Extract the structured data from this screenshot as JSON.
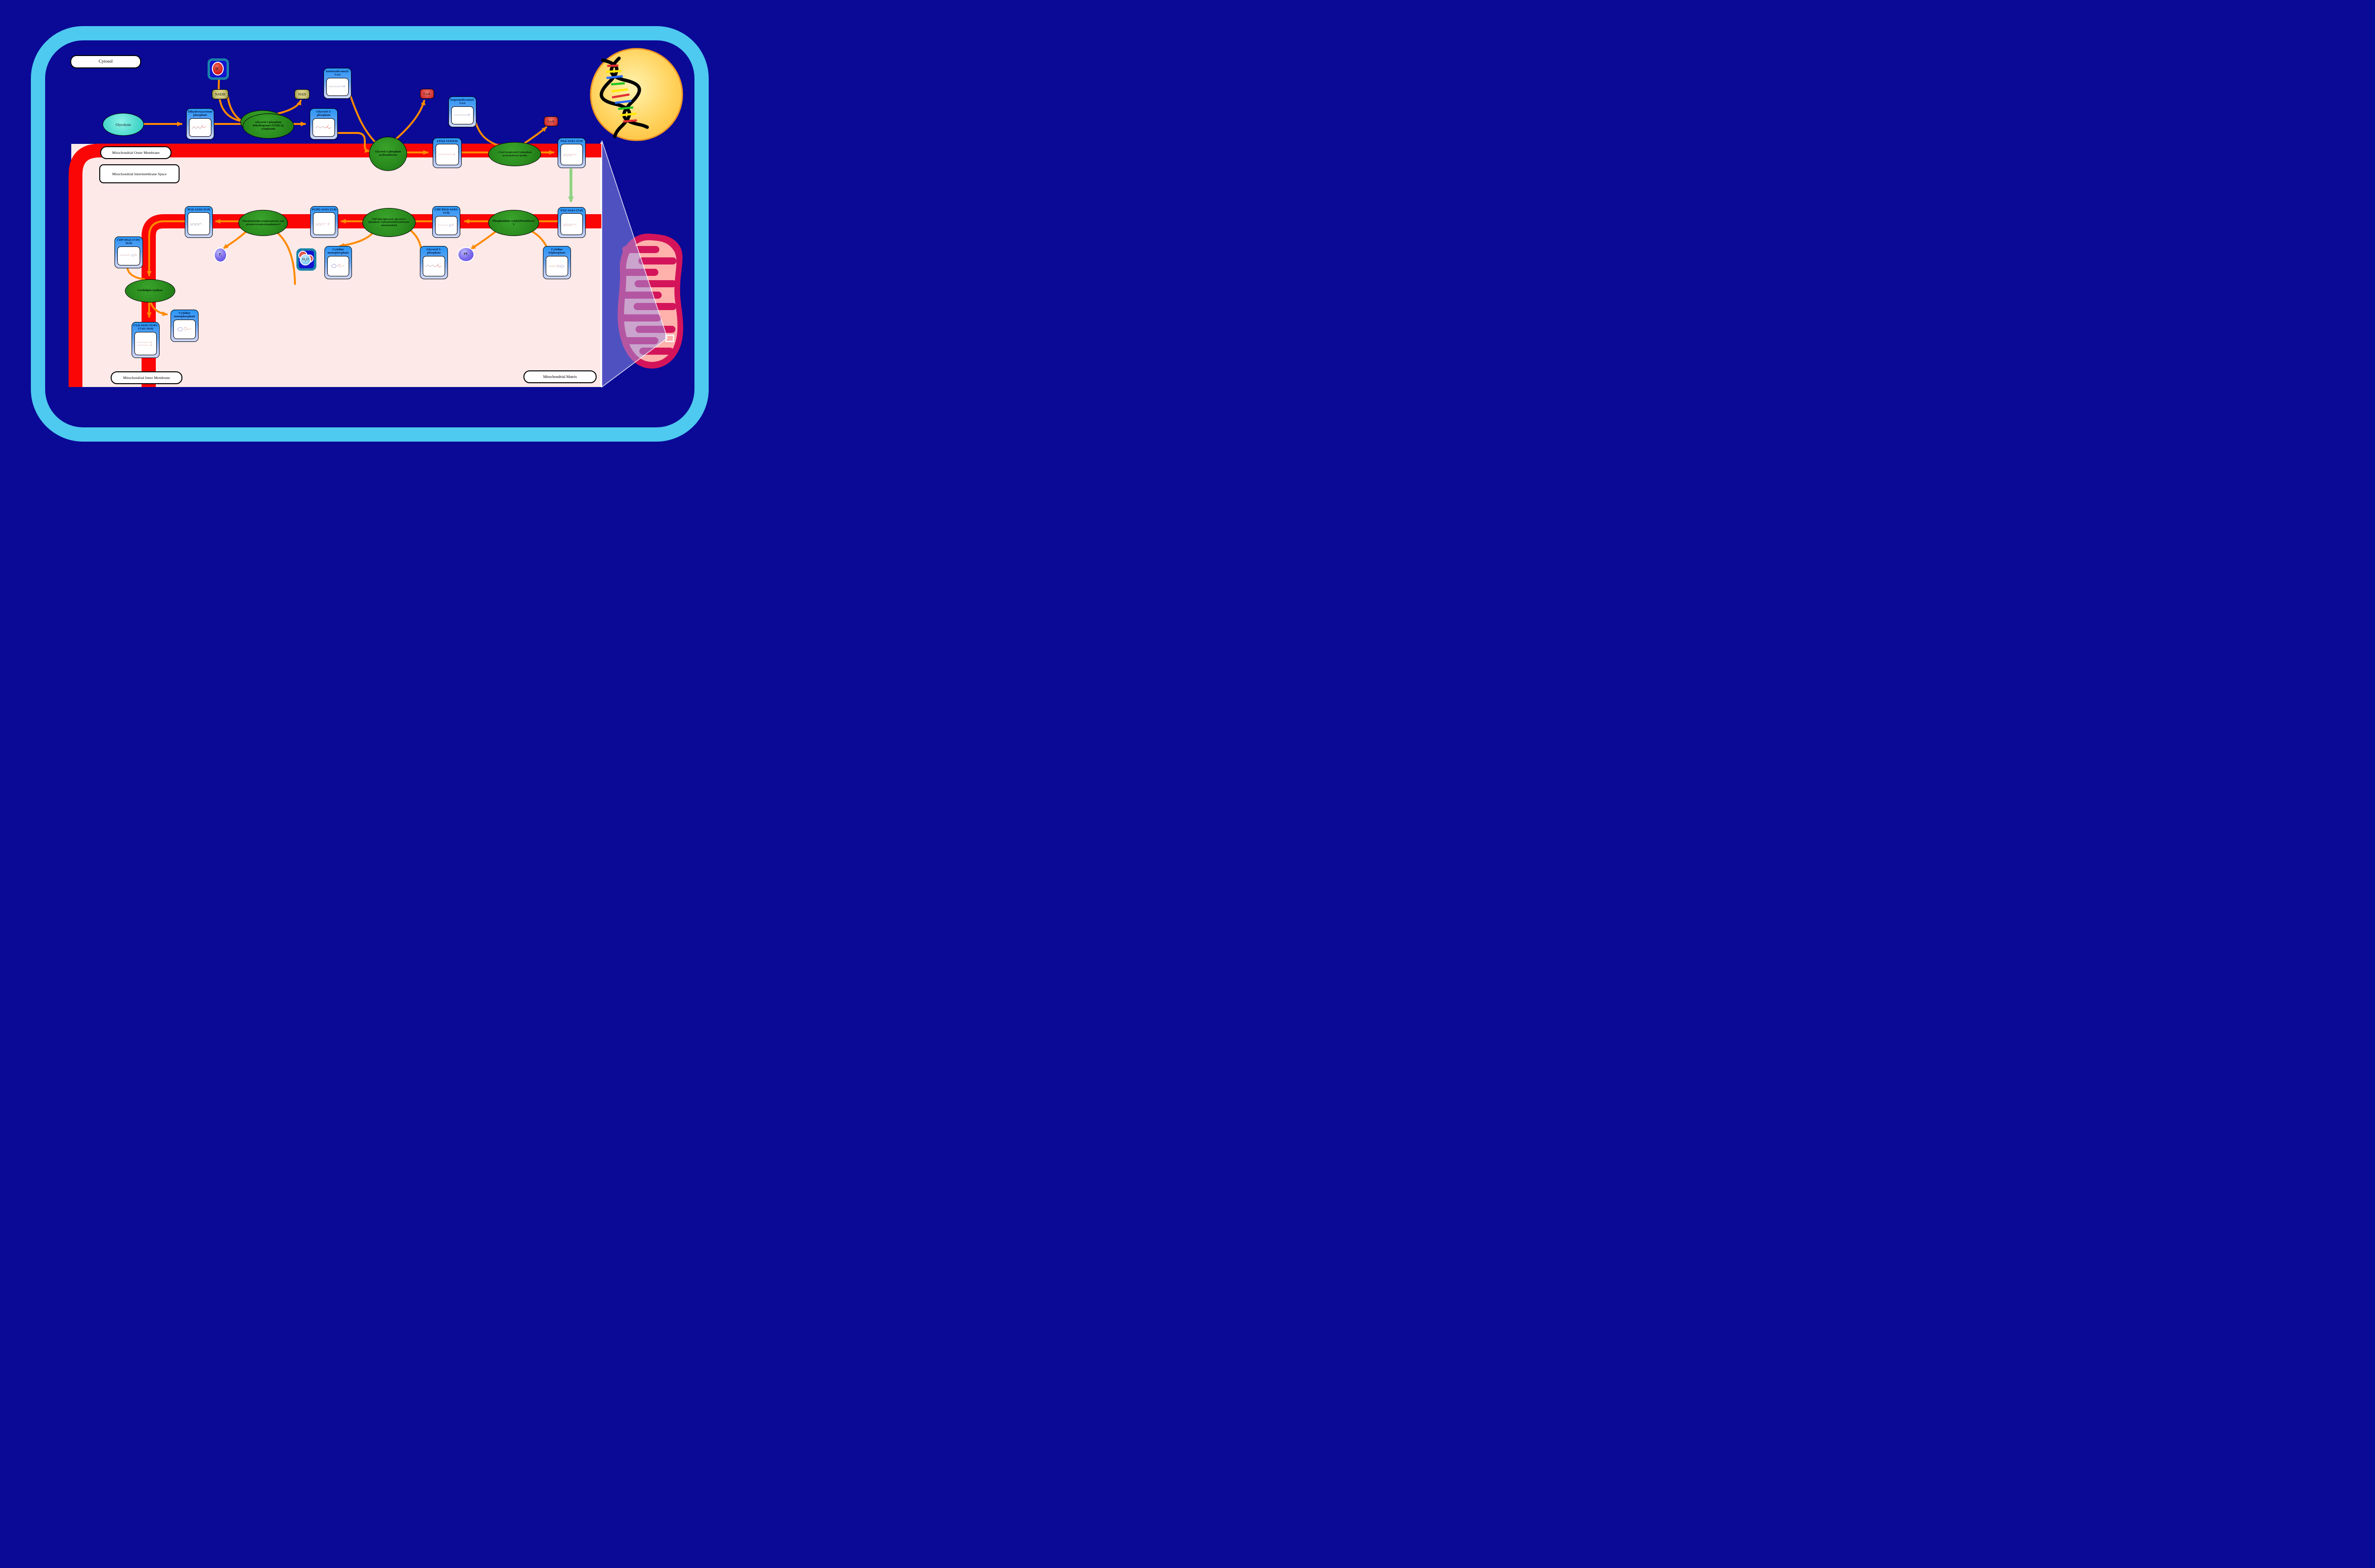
{
  "regions": {
    "cytosol": "Cytosol",
    "outer_membrane": "Mitochondrial Outer Membrane",
    "intermembrane_space": "Mitochondrial Intermembrane Space",
    "inner_membrane": "Mitochondrial Inner Membrane",
    "matrix": "Mitochondrial Matrix"
  },
  "process": {
    "glycolysis": "Glycolysis"
  },
  "enzymes": {
    "gpd": "Glycerol-3-phosphate dehydrogenase [NAD(+)], cytoplasmic",
    "gpat": "Glycerol-3-phosphate acyltransferase",
    "agpat": "1-Acyl-sn-glycerol-3-phosphate acyltransferase epsilon",
    "cds2": "Phosphatidate cytidylyltransferase 2",
    "pgs1": "CDP-diacylglycerol--glycerol-3-phosphate 3-phosphatidyltransferase, mitochondrial",
    "ptpmt1": "Phosphatidylglycerophosphatase and protein-tyrosine phosphatase 1",
    "crls1": "Cardiolipin synthase"
  },
  "metabolites": {
    "dhap": {
      "label": "Dihydroxyacetone phosphate"
    },
    "g3p": {
      "label": "Glycerol 3-phosphate"
    },
    "itdcoa": {
      "label": "Isotetradecanoyl-CoA"
    },
    "ipdcoa": {
      "label": "Isopentadecanoyl-CoA"
    },
    "lpa": {
      "label": "LPA(i-14:0/0:0)"
    },
    "pa_outer": {
      "label": "PA(i-14:0/i-15:0)"
    },
    "pa_inner": {
      "label": "PA(i-14:0/i-15:0)"
    },
    "cdpdg1": {
      "label": "CDP-DG(i-14:0/i-15:0)"
    },
    "pgp": {
      "label": "PGP(i-14:0/i-15:0)"
    },
    "pg": {
      "label": "PG(i-14:0/i-15:0)"
    },
    "cdpdg2": {
      "label": "CDP-DG(i-17:0/i-19:0)"
    },
    "cl": {
      "label": "CL(i-14:0/i-15:0/i-17:0/i-19:0)"
    },
    "cmp1": {
      "label": "Cytidine monophosphate"
    },
    "cmp2": {
      "label": "Cytidine monophosphate"
    },
    "ctp": {
      "label": "Cytidine triphosphate"
    },
    "g3p2": {
      "label": "Glycerol 3-phosphate"
    }
  },
  "cofactors": {
    "nadh": "NADH",
    "nad": "NAD",
    "coa": "CoA",
    "hplus": {
      "base": "H",
      "sup": "+"
    },
    "h2o": {
      "h": "H",
      "sub": "2",
      "o": "O"
    },
    "pi": {
      "base": "P",
      "sub": "i"
    },
    "ppi": {
      "base": "PP",
      "sub": "i"
    }
  },
  "colors": {
    "background_navy": "#0a0a96",
    "cell_border_blue": "#4ec9f0",
    "membrane_red": "#fb0606",
    "intermembrane_pink": "#fce9e8",
    "arrow_orange": "#ff8a00",
    "arrow_green": "#8fd383",
    "node_blue": "#2996f7",
    "enzyme_green": "#1d7412",
    "nucleus_yellow": "#ffb62c",
    "mitochondrion_crimson": "#d4145a",
    "mitochondrion_matrix_salmon": "#ffb1ac"
  }
}
